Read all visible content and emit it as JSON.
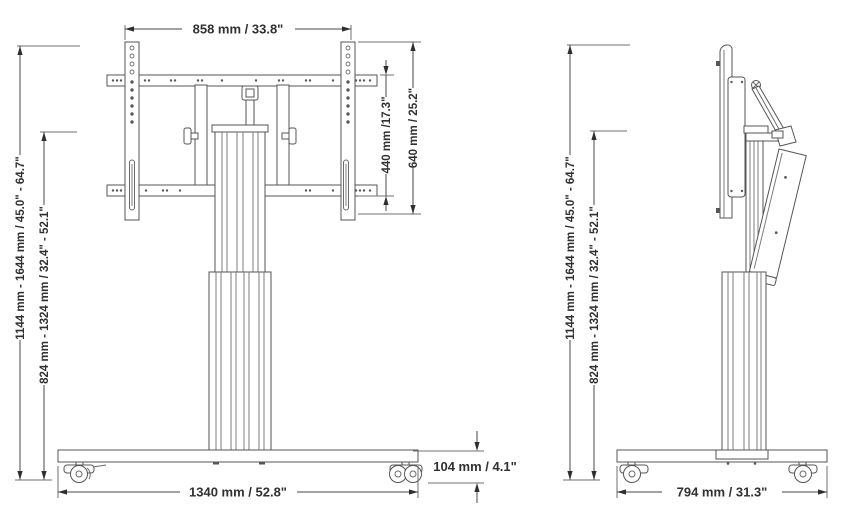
{
  "colors": {
    "background": "#ffffff",
    "drawing_line": "#565656",
    "dimension_line": "#474747",
    "text": "#303030"
  },
  "front_view": {
    "dim_width_top": "858 mm / 33.8\"",
    "dim_inner_height": "440 mm /17.3\"",
    "dim_outer_height": "640 mm / 25.2\"",
    "dim_height_range_max": "1144 mm - 1644 mm / 45.0\" - 64.7\"",
    "dim_height_range_min": "824 mm - 1324 mm / 32.4\" - 52.1\"",
    "dim_base_width": "1340 mm / 52.8\"",
    "dim_base_height": "104 mm / 4.1\""
  },
  "side_view": {
    "dim_height_range_max": "1144 mm - 1644 mm / 45.0\" - 64.7\"",
    "dim_height_range_min": "824 mm - 1324 mm / 32.4\" - 52.1\"",
    "dim_base_depth": "794 mm / 31.3\""
  }
}
